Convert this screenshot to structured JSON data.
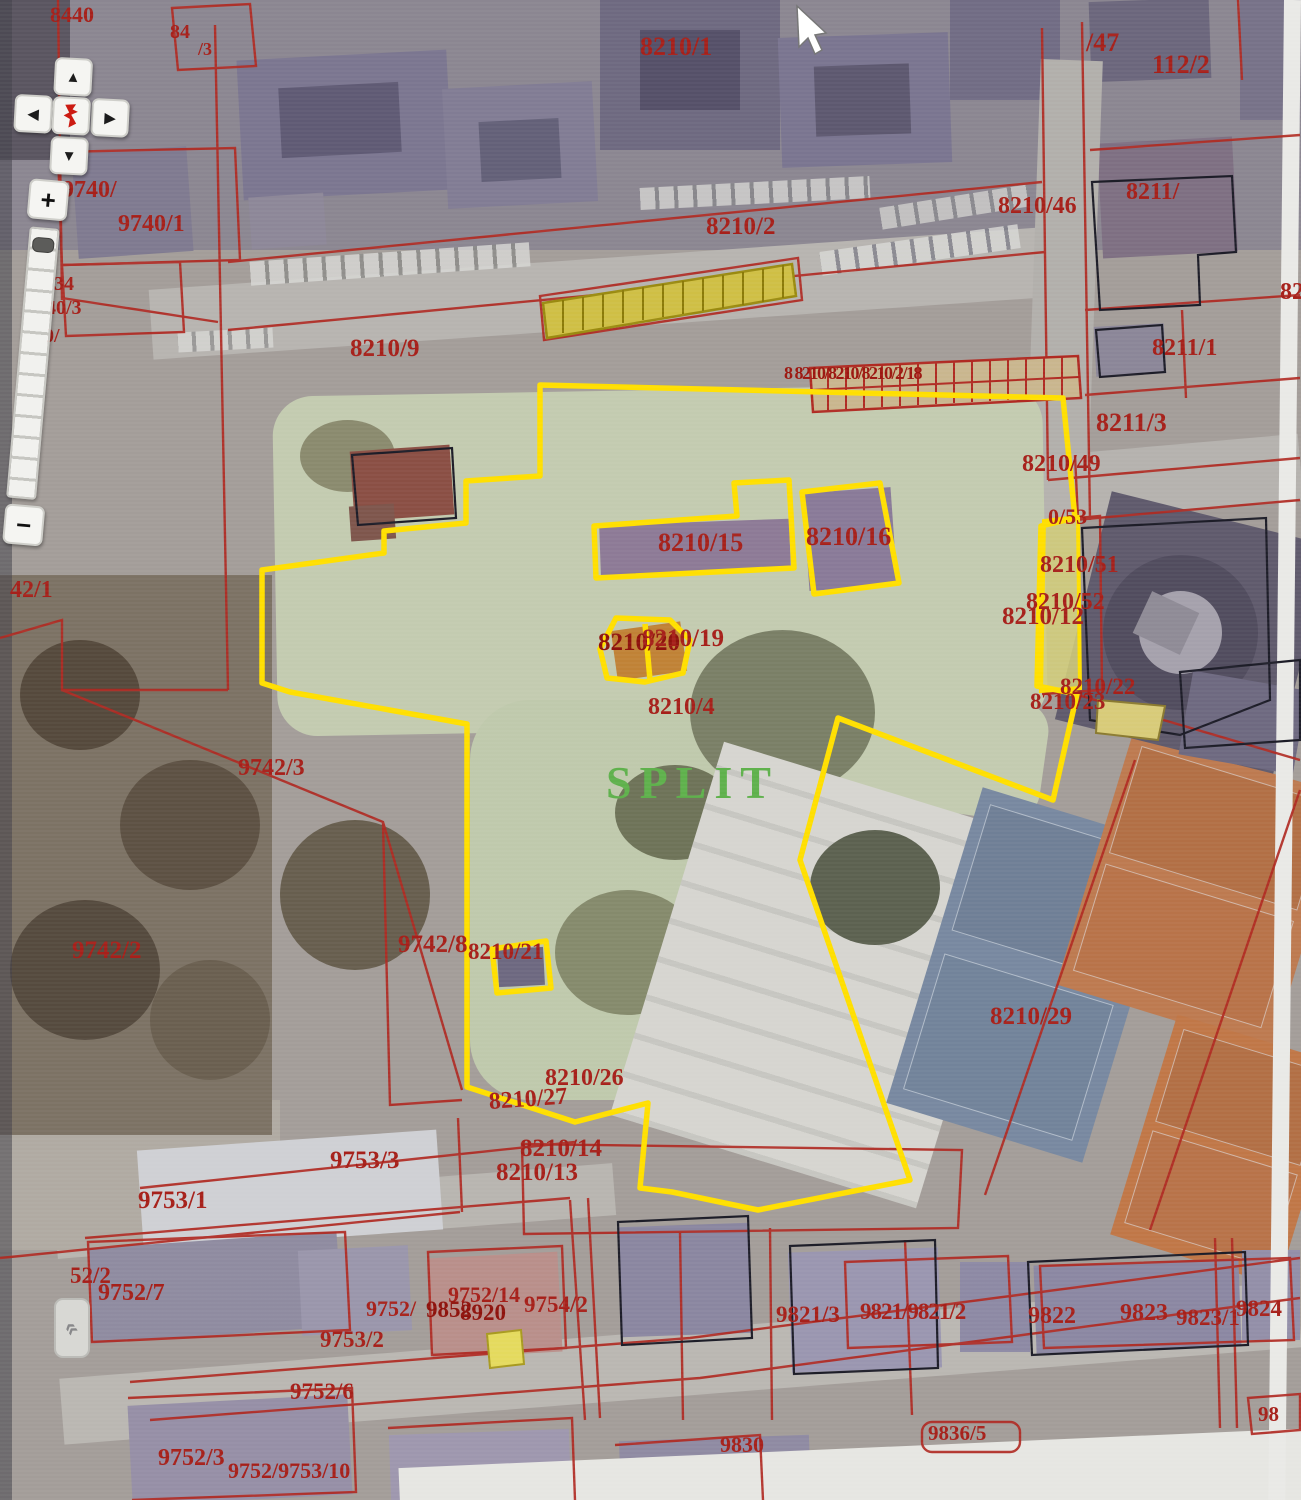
{
  "app": {
    "type": "cadastral-web-gis",
    "city_label": "SPLIT"
  },
  "controls": {
    "pan_up": "▲",
    "pan_left": "◀",
    "pan_right": "▶",
    "pan_down": "▼",
    "zoom_in": "+",
    "zoom_out": "−",
    "panel_toggle": "«",
    "center_logo": "croatia-red-mark"
  },
  "colors": {
    "highlight_parcel": "#ffdf00",
    "cadastral_line": "#b02a22",
    "parcel_label": "#a6201a",
    "city_label": "#5fb14c"
  },
  "map": {
    "labels": [
      {
        "t": "8440",
        "x": 50,
        "y": 4,
        "s": 22
      },
      {
        "t": "84",
        "x": 170,
        "y": 22,
        "s": 20
      },
      {
        "t": "/3",
        "x": 198,
        "y": 40,
        "s": 18
      },
      {
        "t": "8210/1",
        "x": 640,
        "y": 34,
        "s": 26
      },
      {
        "t": "/47",
        "x": 1086,
        "y": 30,
        "s": 26
      },
      {
        "t": "112/2",
        "x": 1152,
        "y": 52,
        "s": 26
      },
      {
        "t": "9740/",
        "x": 62,
        "y": 178,
        "s": 24
      },
      {
        "t": "9740/1",
        "x": 118,
        "y": 212,
        "s": 24
      },
      {
        "t": "34",
        "x": 54,
        "y": 274,
        "s": 20
      },
      {
        "t": "40/3",
        "x": 46,
        "y": 298,
        "s": 20
      },
      {
        "t": "0/",
        "x": 44,
        "y": 326,
        "s": 20
      },
      {
        "t": "8210/2",
        "x": 706,
        "y": 214,
        "s": 25
      },
      {
        "t": "8210/9",
        "x": 350,
        "y": 336,
        "s": 25
      },
      {
        "t": "8 8210/8210/8210/2/18",
        "x": 784,
        "y": 364,
        "s": 18,
        "w": 800,
        "ls": -1.5,
        "c": "#9c1710"
      },
      {
        "t": "8211/",
        "x": 1126,
        "y": 180,
        "s": 24
      },
      {
        "t": "8210/46",
        "x": 998,
        "y": 194,
        "s": 24
      },
      {
        "t": "8211/1",
        "x": 1152,
        "y": 336,
        "s": 24
      },
      {
        "t": "82",
        "x": 1280,
        "y": 280,
        "s": 24
      },
      {
        "t": "8211/3",
        "x": 1096,
        "y": 410,
        "s": 26
      },
      {
        "t": "8210/49",
        "x": 1022,
        "y": 452,
        "s": 24
      },
      {
        "t": "8210/15",
        "x": 658,
        "y": 530,
        "s": 26
      },
      {
        "t": "8210/16",
        "x": 806,
        "y": 524,
        "s": 26
      },
      {
        "t": "0/53",
        "x": 1048,
        "y": 506,
        "s": 22
      },
      {
        "t": "8210/51",
        "x": 1040,
        "y": 553,
        "s": 24
      },
      {
        "t": "8210/52",
        "x": 1026,
        "y": 590,
        "s": 24
      },
      {
        "t": "8210/12",
        "x": 1002,
        "y": 604,
        "s": 25
      },
      {
        "t": "42/1",
        "x": 10,
        "y": 578,
        "s": 24
      },
      {
        "t": "8210/20",
        "x": 598,
        "y": 630,
        "s": 25,
        "w": 800,
        "c": "#8e120c"
      },
      {
        "t": "8210/19",
        "x": 642,
        "y": 626,
        "s": 25
      },
      {
        "t": "8210/4",
        "x": 648,
        "y": 695,
        "s": 24
      },
      {
        "t": "8210/22",
        "x": 1060,
        "y": 675,
        "s": 23,
        "w": 800
      },
      {
        "t": "8210/23",
        "x": 1030,
        "y": 690,
        "s": 23
      },
      {
        "t": "SPLIT",
        "x": 606,
        "y": 760,
        "s": 46,
        "c": "#5fb14c",
        "ls": 8,
        "n": "city-label"
      },
      {
        "t": "9742/3",
        "x": 238,
        "y": 756,
        "s": 24
      },
      {
        "t": "9742/2",
        "x": 72,
        "y": 938,
        "s": 25
      },
      {
        "t": "9742/8",
        "x": 398,
        "y": 932,
        "s": 25
      },
      {
        "t": "8210/21",
        "x": 468,
        "y": 940,
        "s": 23
      },
      {
        "t": "8210/29",
        "x": 990,
        "y": 1004,
        "s": 25
      },
      {
        "t": "8210/26",
        "x": 545,
        "y": 1066,
        "s": 24
      },
      {
        "t": "8210/27",
        "x": 488,
        "y": 1090,
        "s": 24,
        "r": -4
      },
      {
        "t": "8210/14",
        "x": 520,
        "y": 1136,
        "s": 25
      },
      {
        "t": "8210/13",
        "x": 496,
        "y": 1160,
        "s": 25
      },
      {
        "t": "9753/3",
        "x": 330,
        "y": 1148,
        "s": 25
      },
      {
        "t": "9753/1",
        "x": 138,
        "y": 1188,
        "s": 25
      },
      {
        "t": "52/2",
        "x": 70,
        "y": 1264,
        "s": 23
      },
      {
        "t": "9752/7",
        "x": 98,
        "y": 1281,
        "s": 24
      },
      {
        "t": "9752/14",
        "x": 448,
        "y": 1284,
        "s": 22
      },
      {
        "t": "9752/",
        "x": 366,
        "y": 1298,
        "s": 22
      },
      {
        "t": "9852",
        "x": 426,
        "y": 1298,
        "s": 23,
        "w": 800,
        "c": "#8e120c"
      },
      {
        "t": "8920",
        "x": 460,
        "y": 1301,
        "s": 23,
        "w": 800,
        "c": "#8e120c"
      },
      {
        "t": "9754/2",
        "x": 524,
        "y": 1293,
        "s": 23
      },
      {
        "t": "9753/2",
        "x": 320,
        "y": 1328,
        "s": 23
      },
      {
        "t": "9752/6",
        "x": 290,
        "y": 1380,
        "s": 23
      },
      {
        "t": "9752/3",
        "x": 158,
        "y": 1446,
        "s": 24
      },
      {
        "t": "9752/9753/10",
        "x": 228,
        "y": 1460,
        "s": 22
      },
      {
        "t": "9821/3",
        "x": 776,
        "y": 1303,
        "s": 23
      },
      {
        "t": "9821/9821/2",
        "x": 860,
        "y": 1300,
        "s": 23,
        "ls": -1
      },
      {
        "t": "9822",
        "x": 1028,
        "y": 1304,
        "s": 24
      },
      {
        "t": "9823",
        "x": 1120,
        "y": 1301,
        "s": 24
      },
      {
        "t": "9823/1",
        "x": 1176,
        "y": 1306,
        "s": 23,
        "w": 800
      },
      {
        "t": "9824",
        "x": 1236,
        "y": 1297,
        "s": 23
      },
      {
        "t": "9836/5",
        "x": 928,
        "y": 1423,
        "s": 21
      },
      {
        "t": "98",
        "x": 1258,
        "y": 1404,
        "s": 21
      },
      {
        "t": "9830",
        "x": 720,
        "y": 1434,
        "s": 22
      }
    ]
  }
}
